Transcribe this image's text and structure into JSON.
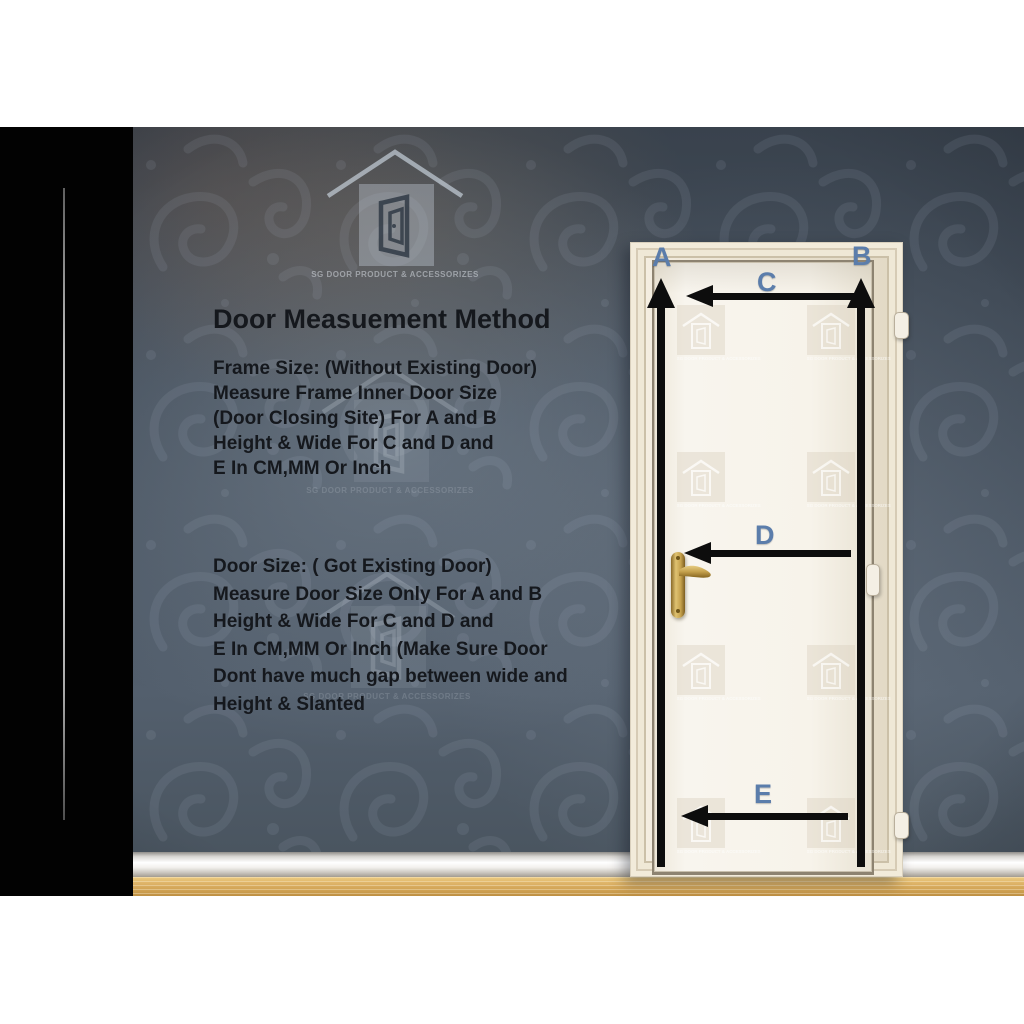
{
  "title": "Door Measuement Method",
  "brand": {
    "label": "SG DOOR PRODUCT & ACCESSORIZES"
  },
  "notes": {
    "frame": {
      "lines": [
        "Frame Size: (Without Existing Door)",
        "Measure Frame Inner Door Size",
        "(Door Closing Site) For A and B",
        "Height & Wide For C and D and",
        "E In CM,MM Or Inch"
      ]
    },
    "door": {
      "lines": [
        "Door Size: ( Got Existing Door)",
        "Measure Door Size Only For A and B",
        "Height & Wide For C and D and",
        "E In CM,MM Or Inch (Make Sure Door",
        "Dont have much gap between wide and",
        "Height & Slanted"
      ]
    }
  },
  "measures": {
    "a": "A",
    "b": "B",
    "c": "C",
    "d": "D",
    "e": "E"
  },
  "colors": {
    "side_panel": "#020202",
    "wallpaper_base": "#47525f",
    "measure_label_blue": "#5b7dab",
    "arrow_black": "#0d0d0d",
    "door_frame_cream": "#ece4d4",
    "door_panel_white": "#f6f2ea",
    "floor_wood": "#ddb266",
    "handle_gold": "#c4a04c"
  }
}
